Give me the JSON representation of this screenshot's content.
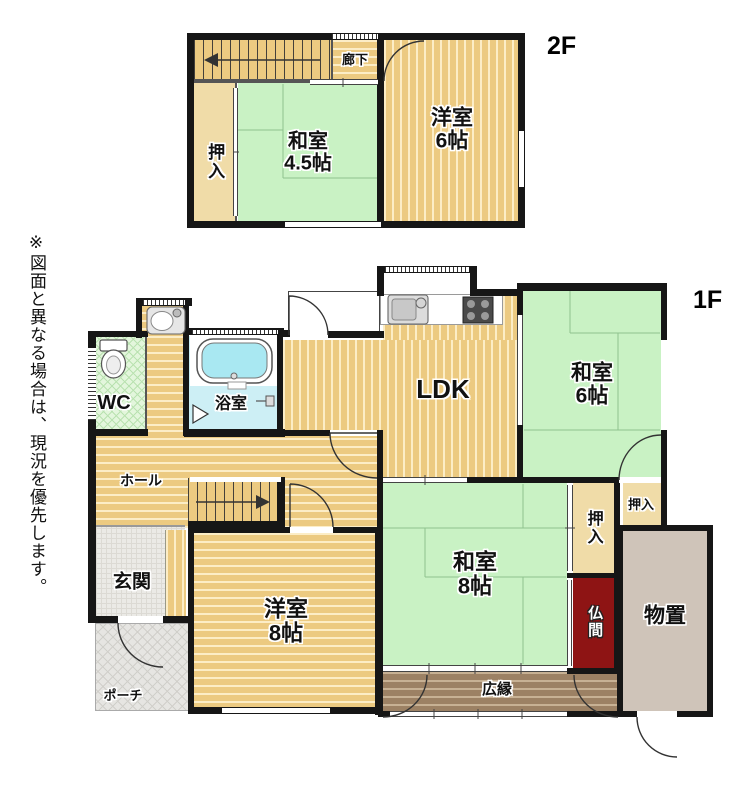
{
  "note": "※図面と異なる場合は、現況を優先します。",
  "floors": {
    "second": {
      "label": "2F",
      "rooms": {
        "rouka": "廊下",
        "oshiire": "押入",
        "washitsu45": "和室\n4.5帖",
        "youshitsu6": "洋室\n6帖"
      }
    },
    "first": {
      "label": "1F",
      "rooms": {
        "wc": "WC",
        "yokushitsu": "浴室",
        "ldk": "LDK",
        "washitsu6": "和室\n6帖",
        "hall": "ホール",
        "genkan": "玄関",
        "porch": "ポーチ",
        "youshitsu8": "洋室\n8帖",
        "washitsu8": "和室\n8帖",
        "oshiire_main": "押入",
        "oshiire_small": "押入",
        "butsuma": "仏間",
        "monooki": "物置",
        "hiroen": "広縁"
      }
    }
  },
  "icons": [
    "stair-arrow-up",
    "stair-arrow-down",
    "toilet-icon",
    "washbasin-icon",
    "bathtub-icon",
    "kitchen-sink-icon",
    "stove-icon",
    "door-swing-arc",
    "bath-door-triangle",
    "bath-mixer-icon"
  ],
  "colors": {
    "wall": "#161616",
    "wood_floor": "#ecca81",
    "tatami": "#c9f2c4",
    "closet": "#f0dca8",
    "bath": "#cdeff5",
    "wc": "#e3f6dc",
    "veranda": "#9c8164",
    "butsudan_room": "#8e1414",
    "storage": "#cfc4b9",
    "entrance": "#ebeae6",
    "background": "#ffffff"
  }
}
